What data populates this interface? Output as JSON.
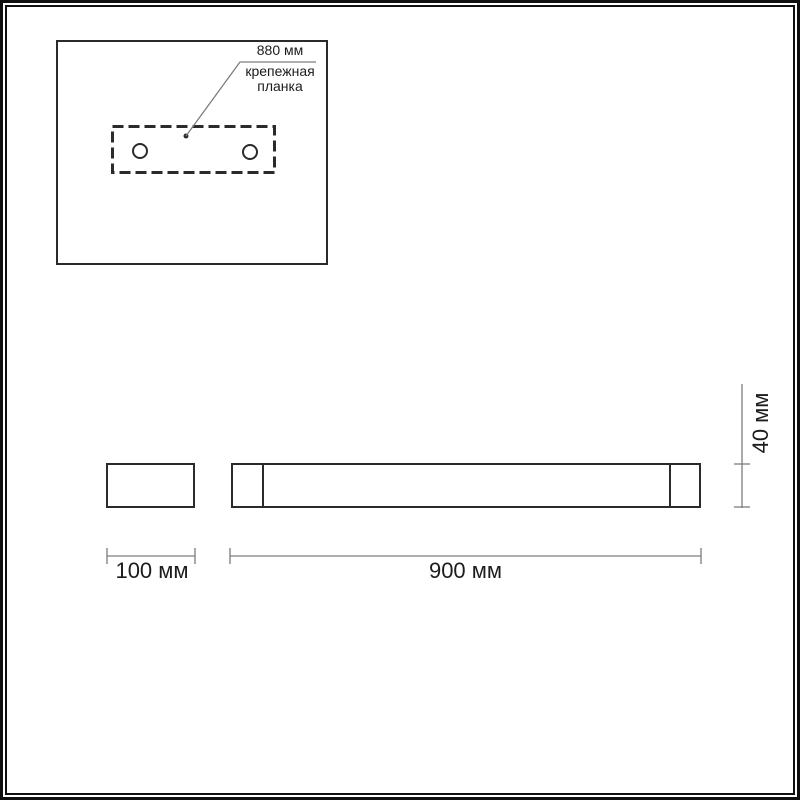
{
  "drawing": {
    "detail_view": {
      "leader_dimension": "880 мм",
      "part_name_line1": "крепежная",
      "part_name_line2": "планка"
    },
    "side_view": {
      "width": "100 мм"
    },
    "front_view": {
      "width": "900 мм",
      "height": "40 мм"
    }
  },
  "colors": {
    "background": "#ffffff",
    "frame": "#101010",
    "line": "#2b2b2b",
    "dim-line": "#7d7d7d",
    "text": "#1c1c1c"
  }
}
